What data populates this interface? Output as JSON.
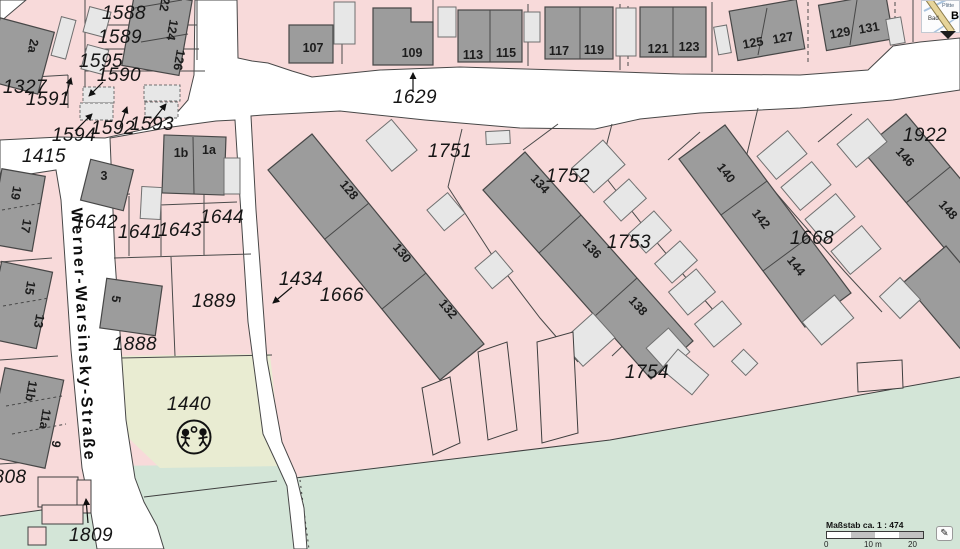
{
  "street": {
    "name": "Werner-Warsinsky-Straße",
    "label_x": 82,
    "label_y": 335
  },
  "parcel_labels": [
    {
      "text": "1588",
      "x": 124,
      "y": 14
    },
    {
      "text": "1589",
      "x": 120,
      "y": 38
    },
    {
      "text": "1595",
      "x": 101,
      "y": 62
    },
    {
      "text": "1590",
      "x": 119,
      "y": 76
    },
    {
      "text": "1327",
      "x": 25,
      "y": 88
    },
    {
      "text": "1591",
      "x": 48,
      "y": 100
    },
    {
      "text": "1594",
      "x": 74,
      "y": 136
    },
    {
      "text": "1592",
      "x": 113,
      "y": 129
    },
    {
      "text": "1593",
      "x": 152,
      "y": 125
    },
    {
      "text": "1415",
      "x": 44,
      "y": 157
    },
    {
      "text": "1642",
      "x": 96,
      "y": 223
    },
    {
      "text": "1641",
      "x": 140,
      "y": 233
    },
    {
      "text": "1643",
      "x": 180,
      "y": 231
    },
    {
      "text": "1644",
      "x": 222,
      "y": 218
    },
    {
      "text": "1629",
      "x": 415,
      "y": 98
    },
    {
      "text": "1751",
      "x": 450,
      "y": 152
    },
    {
      "text": "1752",
      "x": 568,
      "y": 177
    },
    {
      "text": "1753",
      "x": 629,
      "y": 243
    },
    {
      "text": "1434",
      "x": 301,
      "y": 280
    },
    {
      "text": "1666",
      "x": 342,
      "y": 296
    },
    {
      "text": "1668",
      "x": 812,
      "y": 239
    },
    {
      "text": "1922",
      "x": 925,
      "y": 136
    },
    {
      "text": "1889",
      "x": 214,
      "y": 302
    },
    {
      "text": "1888",
      "x": 135,
      "y": 345
    },
    {
      "text": "1440",
      "x": 189,
      "y": 405
    },
    {
      "text": "1754",
      "x": 647,
      "y": 373
    },
    {
      "text": "1809",
      "x": 91,
      "y": 536
    },
    {
      "text": "808",
      "x": 10,
      "y": 478
    }
  ],
  "building_labels": [
    {
      "text": "107",
      "x": 313,
      "y": 48,
      "r": 0
    },
    {
      "text": "109",
      "x": 412,
      "y": 53,
      "r": 0
    },
    {
      "text": "113",
      "x": 473,
      "y": 55,
      "r": 0
    },
    {
      "text": "115",
      "x": 506,
      "y": 53,
      "r": 0
    },
    {
      "text": "117",
      "x": 559,
      "y": 51,
      "r": 0
    },
    {
      "text": "119",
      "x": 594,
      "y": 50,
      "r": 0
    },
    {
      "text": "121",
      "x": 658,
      "y": 49,
      "r": 0
    },
    {
      "text": "123",
      "x": 689,
      "y": 47,
      "r": 0
    },
    {
      "text": "125",
      "x": 753,
      "y": 43,
      "r": -10
    },
    {
      "text": "127",
      "x": 783,
      "y": 38,
      "r": -10
    },
    {
      "text": "129",
      "x": 840,
      "y": 33,
      "r": -10
    },
    {
      "text": "131",
      "x": 869,
      "y": 28,
      "r": -10
    },
    {
      "text": "122",
      "x": 165,
      "y": 1,
      "r": 100
    },
    {
      "text": "124",
      "x": 172,
      "y": 30,
      "r": 100
    },
    {
      "text": "126",
      "x": 179,
      "y": 60,
      "r": 100
    },
    {
      "text": "2a",
      "x": 33,
      "y": 46,
      "r": 100
    },
    {
      "text": "1b",
      "x": 181,
      "y": 153,
      "r": 0
    },
    {
      "text": "1a",
      "x": 209,
      "y": 150,
      "r": 0
    },
    {
      "text": "3",
      "x": 104,
      "y": 176,
      "r": 0
    },
    {
      "text": "5",
      "x": 116,
      "y": 299,
      "r": 100
    },
    {
      "text": "19",
      "x": 16,
      "y": 193,
      "r": 100
    },
    {
      "text": "17",
      "x": 26,
      "y": 226,
      "r": 100
    },
    {
      "text": "15",
      "x": 30,
      "y": 288,
      "r": 100
    },
    {
      "text": "13",
      "x": 39,
      "y": 321,
      "r": 100
    },
    {
      "text": "11b",
      "x": 31,
      "y": 391,
      "r": 100
    },
    {
      "text": "11a",
      "x": 45,
      "y": 419,
      "r": 100
    },
    {
      "text": "9",
      "x": 56,
      "y": 444,
      "r": 100
    },
    {
      "text": "128",
      "x": 349,
      "y": 190,
      "r": 50
    },
    {
      "text": "130",
      "x": 402,
      "y": 253,
      "r": 50
    },
    {
      "text": "132",
      "x": 448,
      "y": 309,
      "r": 50
    },
    {
      "text": "134",
      "x": 540,
      "y": 184,
      "r": 48
    },
    {
      "text": "136",
      "x": 592,
      "y": 249,
      "r": 48
    },
    {
      "text": "138",
      "x": 638,
      "y": 306,
      "r": 48
    },
    {
      "text": "140",
      "x": 726,
      "y": 173,
      "r": 52
    },
    {
      "text": "142",
      "x": 761,
      "y": 219,
      "r": 52
    },
    {
      "text": "144",
      "x": 796,
      "y": 266,
      "r": 52
    },
    {
      "text": "146",
      "x": 905,
      "y": 157,
      "r": 48
    },
    {
      "text": "148",
      "x": 948,
      "y": 210,
      "r": 48
    }
  ],
  "scalebar": {
    "title": "Maßstab ca. 1 : 474",
    "ticks": [
      "0",
      "10 m",
      "20 m"
    ],
    "edit_icon": "✎"
  },
  "inset": {
    "label_top": "Plitte",
    "label_left": "Bad",
    "label_big": "B"
  },
  "colors": {
    "parcel_pink": "#f8dada",
    "road_white": "#ffffff",
    "building_gray": "#9c9c9c",
    "shed_gray": "#e7e7e7",
    "playground_green": "#e9ecd2",
    "meadow_green": "#d3e5d7",
    "line": "#4a4a4a"
  }
}
